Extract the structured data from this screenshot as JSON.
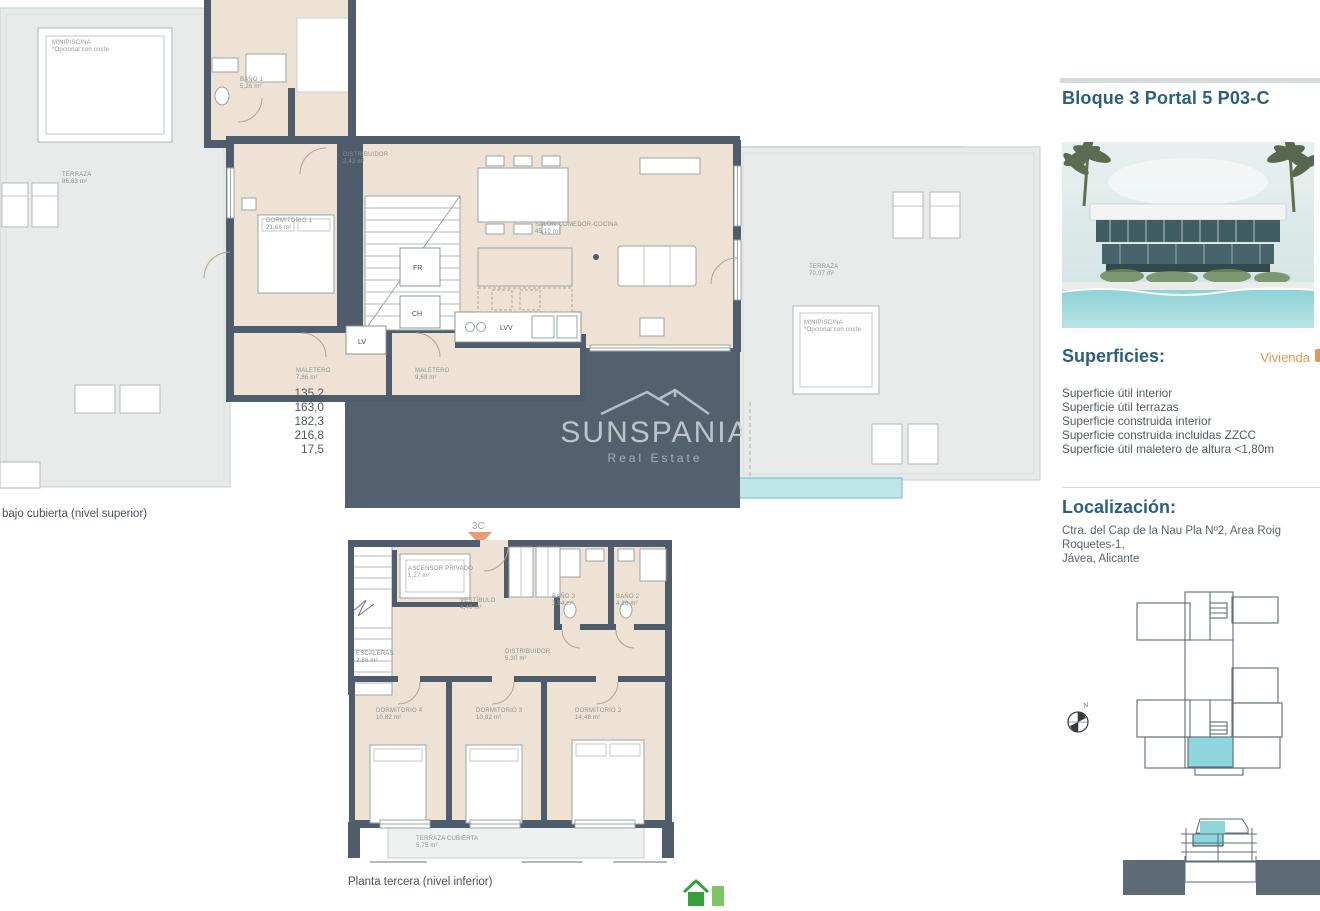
{
  "sidebar": {
    "title": "Bloque 3 Portal 5 P03-C",
    "superficies": {
      "heading": "Superficies:",
      "dwelling_label": "Vivienda",
      "rows": [
        {
          "label": "Superficie útil interior",
          "value": "135,2"
        },
        {
          "label": "Superficie útil terrazas",
          "value": "163,0"
        },
        {
          "label": "Superficie construida interior",
          "value": "182,3"
        },
        {
          "label": "Superficie construida incluidas ZZCC",
          "value": "216,8"
        },
        {
          "label": "Superficie útil maletero de altura <1,80m",
          "value": "17,5"
        }
      ]
    },
    "localizacion": {
      "heading": "Localización:",
      "address_line1": "Ctra. del Cap de la Nau Pla Nº2, Area Roig Roquetes-1,",
      "address_line2": "Jávea, Alicante"
    },
    "compass_label": "N"
  },
  "watermark": {
    "brand": "SUNSPANIA",
    "subtitle": "Real Estate"
  },
  "upper_plan": {
    "caption": "bajo cubierta (nivel superior)",
    "rooms": {
      "banyo1": {
        "name": "BAÑO 1",
        "area": "5,26 m²"
      },
      "dorm1": {
        "name": "DORMITORIO 1",
        "area": "21,66 m²"
      },
      "distribuidor": {
        "name": "DISTRIBUIDOR",
        "area": "2,43 m²"
      },
      "salon": {
        "name": "SALÓN-COMEDOR-COCINA",
        "area": "45,10 m²"
      },
      "maletero1": {
        "name": "MALETERO",
        "area": "7,86 m²"
      },
      "maletero2": {
        "name": "MALETERO",
        "area": "9,69 m²"
      },
      "terraza_left": {
        "name": "TERRAZA",
        "area": "86,63 m²"
      },
      "terraza_right": {
        "name": "TERRAZA",
        "area": "70,07 m²"
      }
    },
    "minipiscina": {
      "name": "MINIPISCINA",
      "note": "*Opcional con coste"
    },
    "appliances": {
      "fr": "FR",
      "ch": "CH",
      "lv": "LV",
      "lvv": "LVV"
    }
  },
  "lower_plan": {
    "caption": "Planta tercera (nivel inferior)",
    "unit_marker": "3C",
    "rooms": {
      "ascensor": {
        "name": "ASCENSOR PRIVADO",
        "area": "1,27 m²"
      },
      "vestibulo": {
        "name": "VESTÍBULO",
        "area": "4,40 m²"
      },
      "escaleras": {
        "name": "ESCALERAS",
        "area": "2,86 m²"
      },
      "distribuidor": {
        "name": "DISTRIBUIDOR",
        "area": "5,30 m²"
      },
      "banyo3": {
        "name": "BAÑO 3",
        "area": "3,94 m²"
      },
      "banyo2": {
        "name": "BAÑO 2",
        "area": "4,16 m²"
      },
      "dorm4": {
        "name": "DORMITORIO 4",
        "area": "10,82 m²"
      },
      "dorm3": {
        "name": "DORMITORIO 3",
        "area": "10,82 m²"
      },
      "dorm2": {
        "name": "DORMITORIO 2",
        "area": "14,48 m²"
      },
      "terraza_cubierta": {
        "name": "TERRAZA CUBIERTA",
        "area": "5,75 m²"
      }
    }
  },
  "colors": {
    "heading_blue": "#2B5F7E",
    "accent_orange": "#E8964F",
    "wall_slate": "#4E5C6B",
    "interior_beige": "#EEE2D5",
    "terrace_gray": "#E9EBEA",
    "highlight_cyan": "#8FD6DC",
    "marker_arrow": "#E99B73",
    "logo_green": "#35A13A"
  }
}
